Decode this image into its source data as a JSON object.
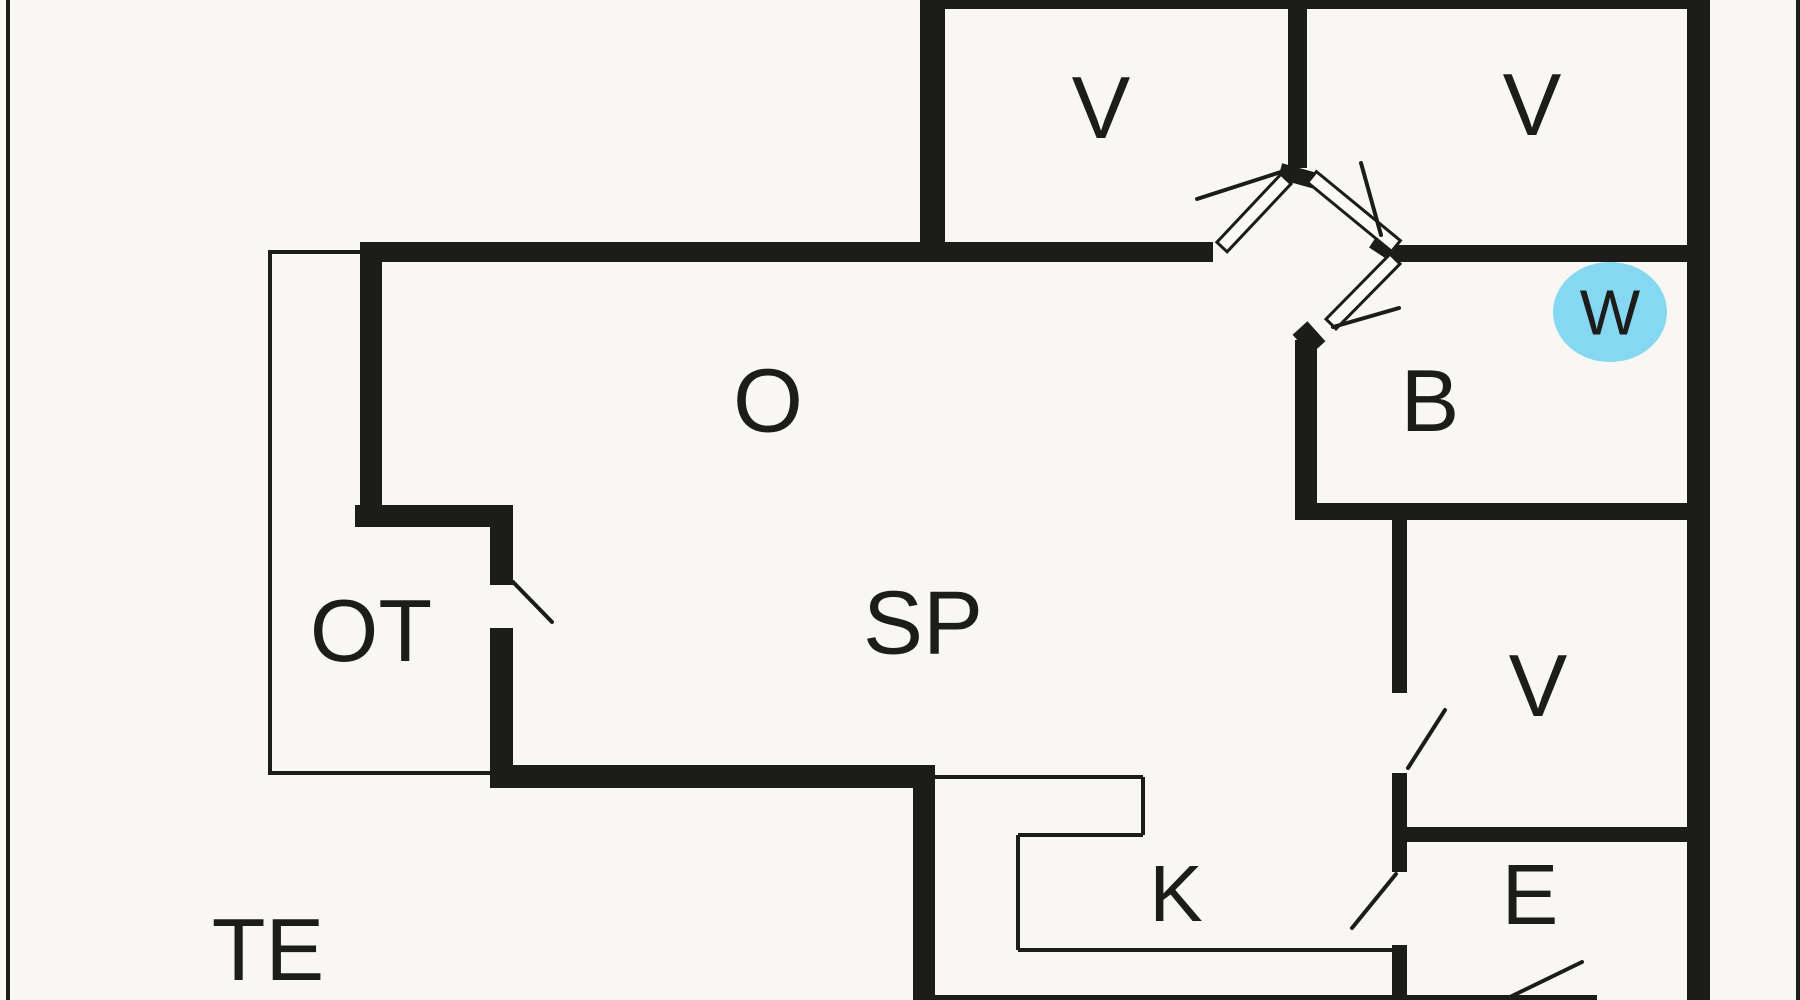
{
  "plan": {
    "type": "floor-plan",
    "canvas": {
      "width": 1800,
      "height": 1000
    },
    "colors": {
      "background": "#f8f7f3",
      "wall": "#1c1c1a",
      "label_text": "#1c1c1a",
      "door_leaf_fill": "#fbfaf6",
      "marker_fill": "#85d7f2",
      "marker_text": "#16404e"
    },
    "rooms": [
      {
        "id": "bedroom-top-center",
        "label": "V",
        "cx": 1101,
        "cy": 107,
        "font": 88
      },
      {
        "id": "bedroom-top-right",
        "label": "V",
        "cx": 1532,
        "cy": 104,
        "font": 88
      },
      {
        "id": "living-room",
        "label": "O",
        "cx": 768,
        "cy": 400,
        "font": 90
      },
      {
        "id": "bathroom",
        "label": "B",
        "cx": 1430,
        "cy": 400,
        "font": 88
      },
      {
        "id": "covered-terrace",
        "label": "OT",
        "cx": 371,
        "cy": 630,
        "font": 88
      },
      {
        "id": "dining-area",
        "label": "SP",
        "cx": 923,
        "cy": 622,
        "font": 90
      },
      {
        "id": "bedroom-mid-right",
        "label": "V",
        "cx": 1538,
        "cy": 685,
        "font": 88
      },
      {
        "id": "kitchen",
        "label": "K",
        "cx": 1176,
        "cy": 893,
        "font": 80
      },
      {
        "id": "entrance",
        "label": "E",
        "cx": 1530,
        "cy": 894,
        "font": 85
      },
      {
        "id": "terrace",
        "label": "TE",
        "cx": 268,
        "cy": 949,
        "font": 88
      }
    ],
    "marker": {
      "id": "wc-marker",
      "label": "W",
      "cx": 1610,
      "cy": 312,
      "rx": 57,
      "ry": 50,
      "font": 64
    },
    "walls_thick": [
      [
        922,
        0,
        788,
        9
      ],
      [
        920,
        0,
        25,
        262
      ],
      [
        360,
        242,
        853,
        20
      ],
      [
        360,
        242,
        22,
        285
      ],
      [
        355,
        505,
        158,
        22
      ],
      [
        490,
        505,
        23,
        80
      ],
      [
        490,
        628,
        23,
        160
      ],
      [
        490,
        765,
        445,
        23
      ],
      [
        913,
        765,
        22,
        235
      ],
      [
        1288,
        0,
        19,
        168
      ],
      [
        1398,
        245,
        289,
        17
      ],
      [
        1295,
        340,
        22,
        178
      ],
      [
        1295,
        503,
        392,
        17
      ],
      [
        1392,
        518,
        15,
        175
      ],
      [
        1392,
        773,
        15,
        99
      ],
      [
        1392,
        945,
        15,
        55
      ],
      [
        1400,
        827,
        287,
        15
      ],
      [
        1687,
        0,
        23,
        1000
      ],
      [
        913,
        995,
        684,
        5
      ]
    ],
    "border_lines": [
      [
        6,
        0,
        4,
        1000
      ],
      [
        1796,
        0,
        4,
        1000
      ]
    ],
    "walls_thin": [
      [
        268,
        252,
        360,
        252
      ],
      [
        270,
        250,
        270,
        775
      ],
      [
        268,
        773,
        493,
        773
      ],
      [
        935,
        777,
        1143,
        777
      ],
      [
        1143,
        777,
        1143,
        835
      ],
      [
        1143,
        835,
        1018,
        835
      ],
      [
        1018,
        835,
        1018,
        950
      ],
      [
        1018,
        950,
        1393,
        950
      ]
    ],
    "door_swings": [
      [
        513,
        582,
        552,
        622
      ],
      [
        1408,
        768,
        1445,
        710
      ],
      [
        1352,
        928,
        1396,
        874
      ],
      [
        1510,
        997,
        1582,
        962
      ],
      [
        1197,
        199,
        1284,
        171
      ],
      [
        1361,
        163,
        1381,
        235
      ],
      [
        1333,
        327,
        1399,
        308
      ]
    ],
    "door_leaves": [
      {
        "x1": 1222,
        "y1": 247,
        "x2": 1286,
        "y2": 179,
        "hw": 7
      },
      {
        "x1": 1312,
        "y1": 177,
        "x2": 1396,
        "y2": 246,
        "hw": 7
      },
      {
        "x1": 1395,
        "y1": 259,
        "x2": 1331,
        "y2": 324,
        "hw": 7
      }
    ],
    "wall_nubs": [
      {
        "x1": 1280,
        "y1": 171,
        "x2": 1316,
        "y2": 181,
        "w": 16
      },
      {
        "x1": 1374,
        "y1": 240,
        "x2": 1400,
        "y2": 257,
        "w": 18
      },
      {
        "x1": 1300,
        "y1": 328,
        "x2": 1318,
        "y2": 348,
        "w": 20
      }
    ]
  }
}
